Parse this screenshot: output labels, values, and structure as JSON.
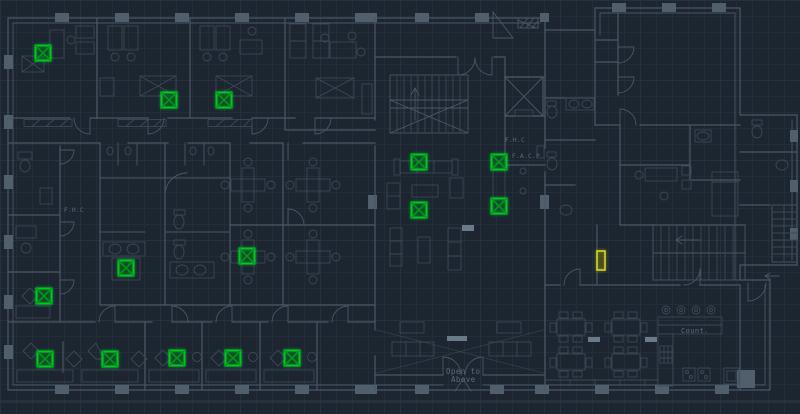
{
  "canvas": {
    "width": 800,
    "height": 414
  },
  "palette": {
    "background": "#1c2530",
    "grid_minor": "#222d3a",
    "grid_major": "#263140",
    "wall": "#4b5765",
    "furniture": "#3d4955",
    "column_fill": "#515e6b",
    "threshold_fill": "#6b7a89",
    "text": "#5d6b7c",
    "device_green": "#00c81f",
    "device_green_dark": "#00961a",
    "selected_yellow": "#d6d71e"
  },
  "labels": [
    {
      "id": "fhc-left",
      "text": "F.H.C",
      "x": 64,
      "y": 212,
      "size": 6
    },
    {
      "id": "fhc-center",
      "text": "F.H.C",
      "x": 505,
      "y": 142,
      "size": 6
    },
    {
      "id": "facp",
      "text": "F.A.C.P",
      "x": 512,
      "y": 158,
      "size": 6
    },
    {
      "id": "open-to",
      "text": "Open to",
      "x": 446,
      "y": 374,
      "size": 7.5
    },
    {
      "id": "above",
      "text": "Above",
      "x": 451,
      "y": 382,
      "size": 7.5
    },
    {
      "id": "counter",
      "text": "Count.",
      "x": 681,
      "y": 333,
      "size": 7
    }
  ],
  "devices": {
    "symbol": "square-with-cross-block",
    "size": 15,
    "positions": [
      {
        "x": 43,
        "y": 53
      },
      {
        "x": 169,
        "y": 100
      },
      {
        "x": 224,
        "y": 100
      },
      {
        "x": 419,
        "y": 162
      },
      {
        "x": 499,
        "y": 162
      },
      {
        "x": 419,
        "y": 210
      },
      {
        "x": 499,
        "y": 206
      },
      {
        "x": 126,
        "y": 268
      },
      {
        "x": 247,
        "y": 256
      },
      {
        "x": 44,
        "y": 296
      },
      {
        "x": 45,
        "y": 359
      },
      {
        "x": 110,
        "y": 359
      },
      {
        "x": 177,
        "y": 358
      },
      {
        "x": 233,
        "y": 358
      },
      {
        "x": 292,
        "y": 358
      }
    ]
  },
  "selected_device": {
    "x": 597,
    "y": 251,
    "width": 8,
    "height": 19
  }
}
